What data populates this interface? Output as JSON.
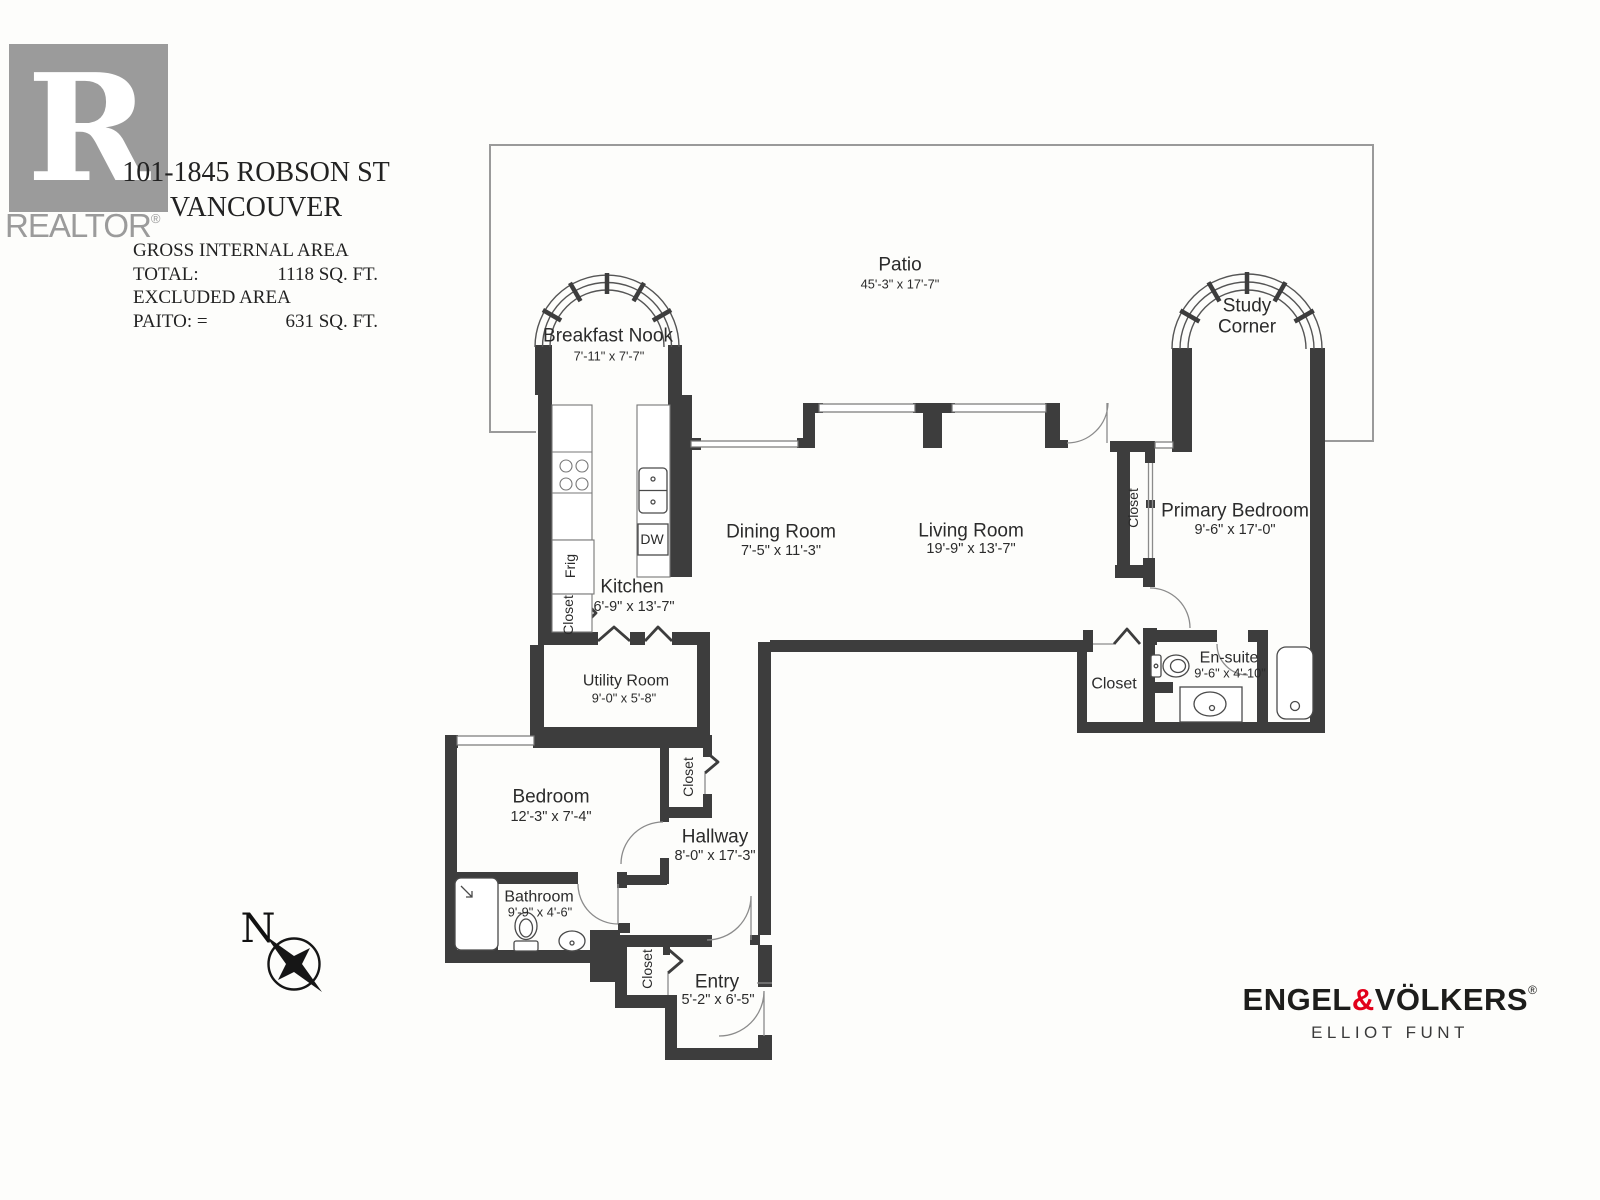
{
  "header": {
    "logo": {
      "letter": "R",
      "word": "REALTOR",
      "registered": "®"
    },
    "address_line1": "101-1845 ROBSON ST",
    "address_line2": "VANCOUVER",
    "stats": {
      "title": "GROSS INTERNAL AREA",
      "total_label": "TOTAL:",
      "total_value": "1118 SQ. FT.",
      "excluded_label": "EXCLUDED AREA",
      "patio_label": "PAITO: =",
      "patio_value": "631 SQ. FT."
    }
  },
  "plan": {
    "rooms": {
      "patio": {
        "name": "Patio",
        "dims": "45'-3\" x 17'-7\""
      },
      "breakfast_nook": {
        "name": "Breakfast Nook",
        "dims": "7'-11\" x 7'-7\""
      },
      "study_corner": {
        "line1": "Study",
        "line2": "Corner"
      },
      "kitchen": {
        "name": "Kitchen",
        "dims": "6'-9\" x 13'-7\""
      },
      "dining_room": {
        "name": "Dining Room",
        "dims": "7'-5\" x 11'-3\""
      },
      "living_room": {
        "name": "Living Room",
        "dims": "19'-9\" x 13'-7\""
      },
      "primary_bedroom": {
        "name": "Primary Bedroom",
        "dims": "9'-6\" x 17'-0\""
      },
      "ensuite": {
        "name": "En-suite",
        "dims": "9'-6\" x 4'-10\""
      },
      "utility_room": {
        "name": "Utility Room",
        "dims": "9'-0\" x 5'-8\""
      },
      "bedroom": {
        "name": "Bedroom",
        "dims": "12'-3\" x 7'-4\""
      },
      "hallway": {
        "name": "Hallway",
        "dims": "8'-0\" x 17'-3\""
      },
      "bathroom": {
        "name": "Bathroom",
        "dims": "9'-9\" x 4'-6\""
      },
      "entry": {
        "name": "Entry",
        "dims": "5'-2\" x 6'-5\""
      }
    },
    "labels": {
      "closet": "Closet",
      "frig": "Frig",
      "dw": "DW"
    },
    "compass_n": "N"
  },
  "footer": {
    "brand_engel": "ENGEL",
    "brand_amp": "&",
    "brand_volkers": "VÖLKERS",
    "registered": "®",
    "subtitle": "ELLIOT FUNT"
  },
  "colors": {
    "wall": "#3d3d3d",
    "brand_red": "#e2001a",
    "logo_gray": "#9b9b9b"
  }
}
